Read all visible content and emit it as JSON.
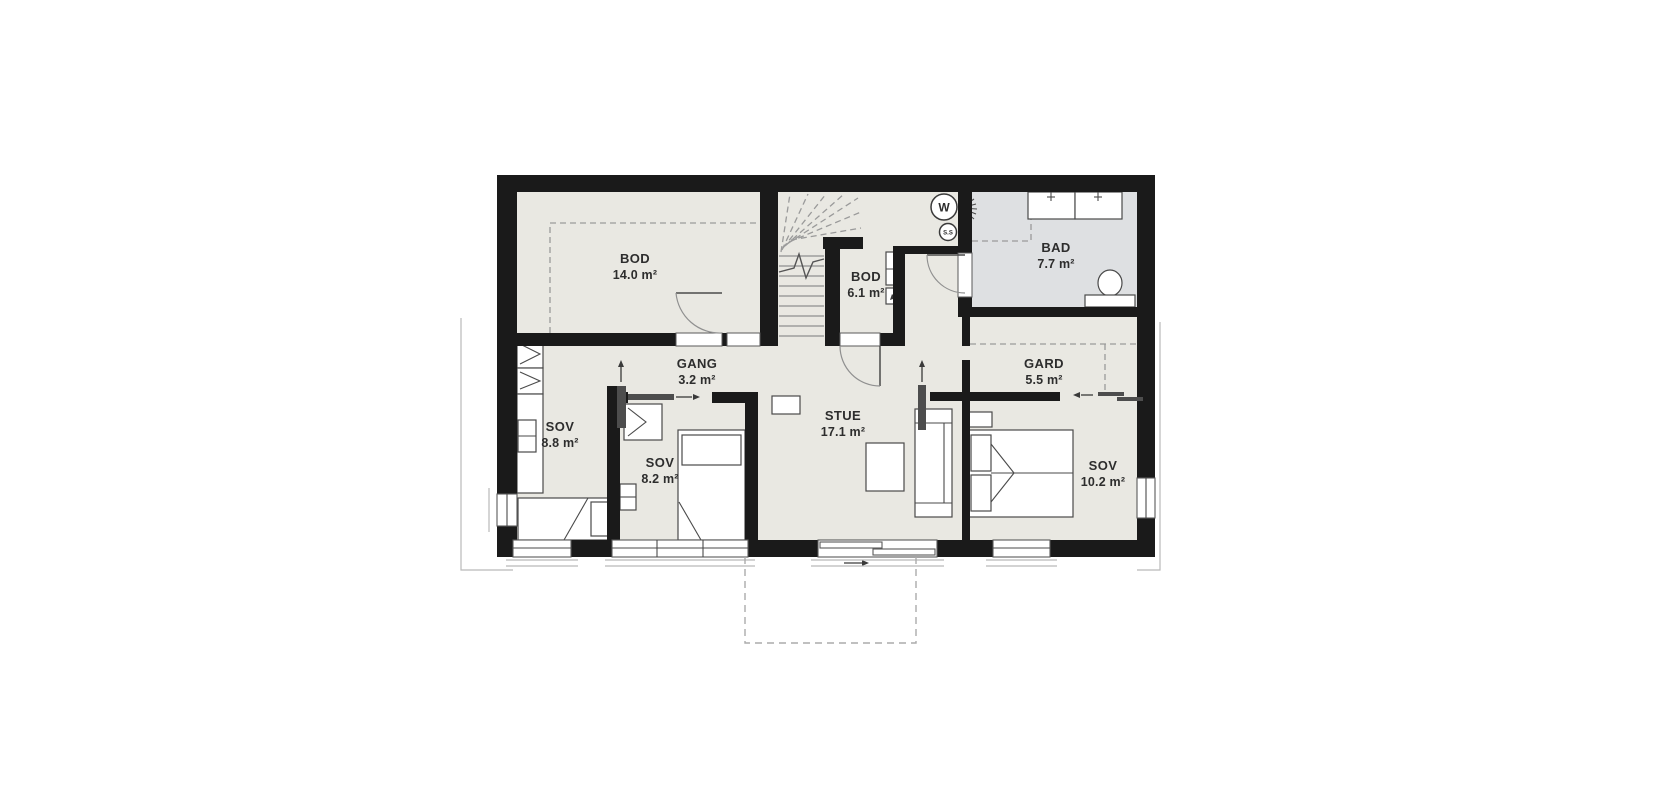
{
  "floorplan": {
    "rooms": [
      {
        "name": "BOD",
        "area": "14.0 m²"
      },
      {
        "name": "BOD",
        "area": "6.1 m²"
      },
      {
        "name": "BAD",
        "area": "7.7 m²"
      },
      {
        "name": "GANG",
        "area": "3.2 m²"
      },
      {
        "name": "GARD",
        "area": "5.5 m²"
      },
      {
        "name": "SOV",
        "area": "8.8 m²"
      },
      {
        "name": "SOV",
        "area": "8.2 m²"
      },
      {
        "name": "STUE",
        "area": "17.1 m²"
      },
      {
        "name": "SOV",
        "area": "10.2 m²"
      }
    ],
    "appliance_symbols": [
      {
        "label": "W"
      },
      {
        "label": "S.S"
      }
    ],
    "colors": {
      "wall": "#1a1a1a",
      "floor": "#e9e8e2",
      "bathroom_floor": "#dee0e2",
      "label": "#2d2d2d"
    }
  }
}
